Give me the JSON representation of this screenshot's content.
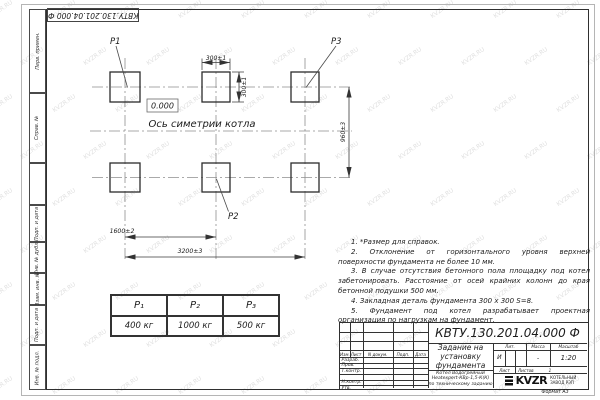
{
  "watermark": "KVZR.RU",
  "corner_stamp": {
    "designation": "КВТУ.130.201.04.000  Ф"
  },
  "side_strip": {
    "cells": [
      {
        "label": "Перв. примен."
      },
      {
        "label": "Справ. №"
      },
      {
        "label": ""
      },
      {
        "label": "Подп. и дата"
      },
      {
        "label": "Инв. № дубл."
      },
      {
        "label": "Взам. инв. №"
      },
      {
        "label": "Подп. и дата"
      },
      {
        "label": "Инв. № подл."
      }
    ]
  },
  "drawing": {
    "p1": "P1",
    "p2": "P2",
    "p3": "P3",
    "elevation": "0.000",
    "axis": "Ось симетрии котла",
    "dim_top_width": "300±1",
    "dim_top_height": "300±1",
    "dim_vertical": "960±3",
    "dim_half_span": "1600±2",
    "dim_full_span": "3200±3"
  },
  "loads_table": {
    "columns": [
      "P₁",
      "P₂",
      "P₃"
    ],
    "values": [
      "400 кг",
      "1000 кг",
      "500 кг"
    ]
  },
  "notes": {
    "items": [
      "1. *Размер для справок.",
      "2. Отклонение от горизонтального уровня верхней поверхности фундамента не более 10 мм.",
      "3. В случае отсутствия бетонного пола площадку под котел забетонировать. Расстояние от осей крайних колонн до края бетонной подушки 500 мм.",
      "4. Закладная деталь фундамента  300 x 300  S=8.",
      "5. Фундамент под котел разрабатывает проектная организация по нагрузкам на фундамент."
    ]
  },
  "title_block": {
    "designation": "КВТУ.130.201.04.000  Ф",
    "title_lines": [
      "Задание на",
      "установку",
      "фундамента"
    ],
    "subtitle_lines": [
      "Котел Водогрейный",
      "Heatexpert-КВр-1,5-К(К)",
      "по техническому заданию"
    ],
    "header_cols": [
      "Изм.",
      "Лист",
      "N докум.",
      "Подп.",
      "Дата"
    ],
    "sign_rows": [
      "Разраб.",
      "Пров.",
      "Т.контр.",
      "",
      "Н.контр.",
      "Утв."
    ],
    "lit": {
      "label": "Лит.",
      "value": "И"
    },
    "mass": {
      "label": "Масса",
      "value": "-"
    },
    "scale": {
      "label": "Масштаб",
      "value": "1:20"
    },
    "sheet": {
      "label": "Лист"
    },
    "sheets": {
      "label": "Листов",
      "value": "1"
    },
    "company": {
      "logo_text": "KVZR",
      "name_line1": "КОТЕЛЬНЫЙ",
      "name_line2": "ЗАВОД РЭП"
    },
    "format_note": "Формат А3"
  }
}
